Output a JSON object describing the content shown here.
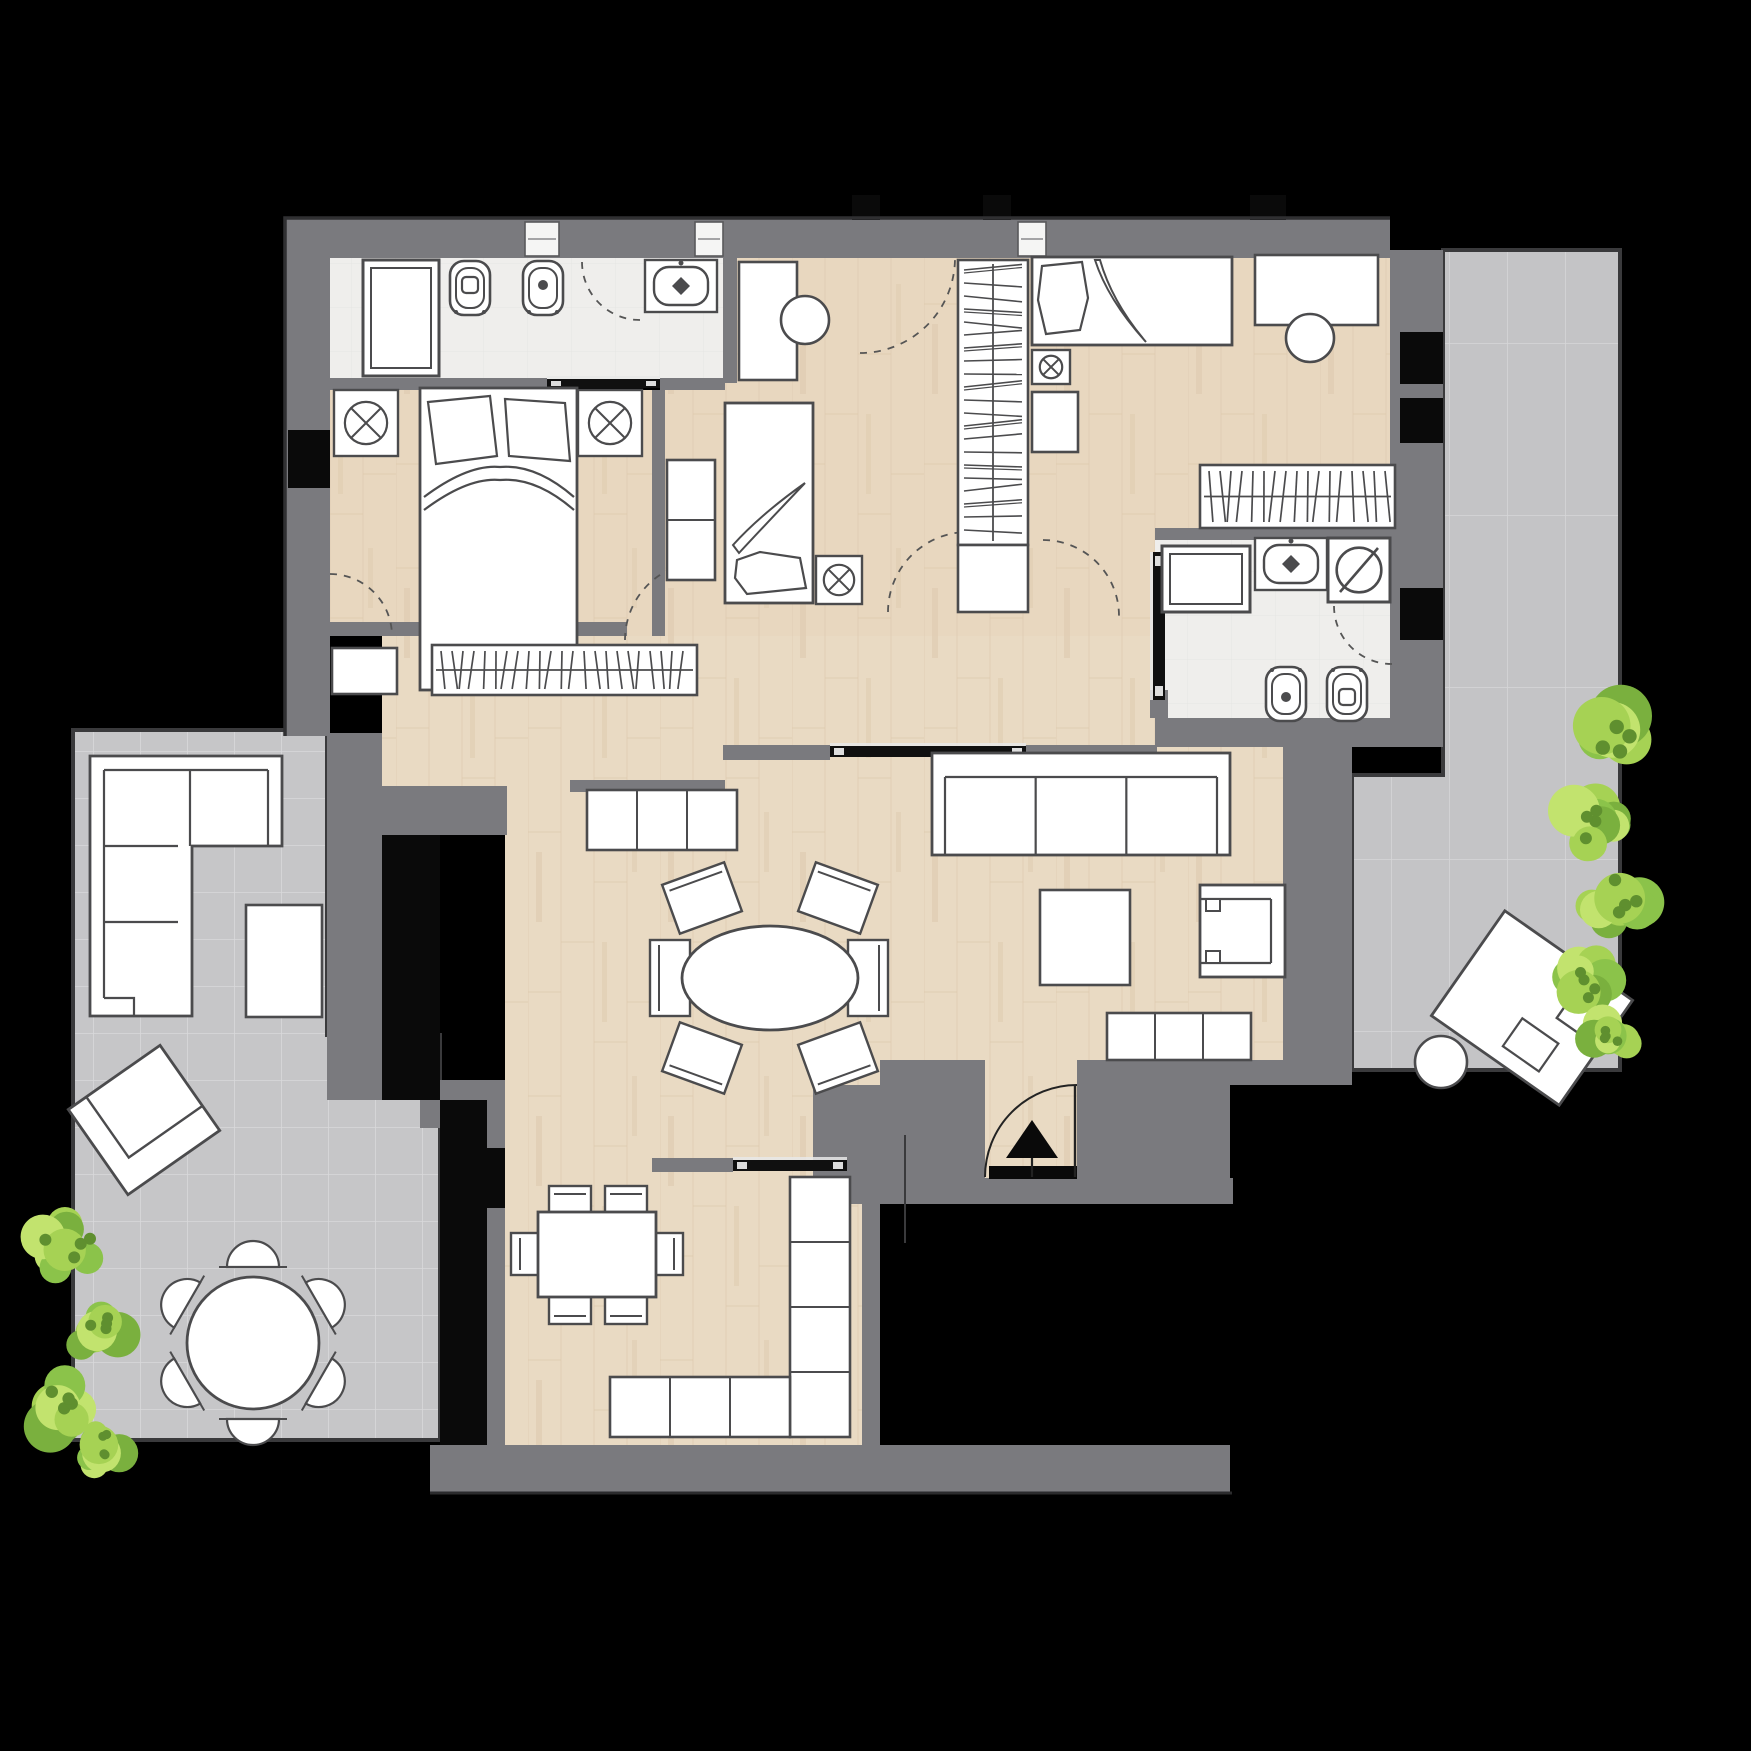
{
  "canvas": {
    "w": 1751,
    "h": 1751
  },
  "palette": {
    "background": "#000000",
    "wall": "#7a7a7e",
    "wallEdge": "#303032",
    "gap": "#0a0a0a",
    "furnFill": "#ffffff",
    "furnStroke": "#4b4b4d",
    "doorBlack": "#101010",
    "arcStroke": "#555555",
    "woodBase": "#e9dac3",
    "woodLine": "#dcc8ab",
    "bedroomTint": "#e3cbb2",
    "tileBase": "#c6c6c8",
    "tileLine": "#d9d9db",
    "bathBase": "#efeeec",
    "bathLine": "#e6e5e3",
    "greens": [
      "#a6d254",
      "#8bc34a",
      "#7ab03e",
      "#c2e36e"
    ],
    "greenDark": "#5f8f2f"
  },
  "elements": [
    {
      "t": "room",
      "name": "terrace-left",
      "floor": "tileA",
      "pts": [
        [
          73,
          730
        ],
        [
          327,
          730
        ],
        [
          327,
          1035
        ],
        [
          440,
          1035
        ],
        [
          440,
          1440
        ],
        [
          73,
          1440
        ]
      ]
    },
    {
      "t": "room",
      "name": "terrace-right",
      "floor": "tileB",
      "pts": [
        [
          1443,
          250
        ],
        [
          1620,
          250
        ],
        [
          1620,
          1070
        ],
        [
          1352,
          1070
        ],
        [
          1352,
          775
        ],
        [
          1443,
          775
        ]
      ]
    },
    {
      "t": "room",
      "name": "bedroom-2-floor",
      "floor": "wood",
      "x": 665,
      "y": 258,
      "w": 365,
      "h": 392,
      "tint": 1
    },
    {
      "t": "room",
      "name": "bedroom-3-floor",
      "floor": "wood",
      "x": 1030,
      "y": 258,
      "w": 360,
      "h": 282,
      "tint": 1
    },
    {
      "t": "room",
      "name": "bedroom-1-floor",
      "floor": "wood",
      "x": 330,
      "y": 390,
      "w": 322,
      "h": 246,
      "tint": 1
    },
    {
      "t": "room",
      "name": "corridor-floor",
      "floor": "wood",
      "x": 652,
      "y": 528,
      "w": 503,
      "h": 132,
      "tint": 1
    },
    {
      "t": "room",
      "name": "hall-floor",
      "floor": "wood",
      "x": 652,
      "y": 636,
      "w": 503,
      "h": 150
    },
    {
      "t": "room",
      "name": "nook-floor",
      "floor": "wood",
      "x": 382,
      "y": 636,
      "w": 341,
      "h": 150
    },
    {
      "t": "room",
      "name": "living-floor",
      "floor": "wood",
      "x": 505,
      "y": 786,
      "w": 778,
      "h": 299
    },
    {
      "t": "room",
      "name": "living-floor-east",
      "floor": "wood",
      "x": 1155,
      "y": 747,
      "w": 128,
      "h": 45
    },
    {
      "t": "room",
      "name": "kitchen-floor",
      "floor": "wood",
      "x": 505,
      "y": 1085,
      "w": 375,
      "h": 360
    },
    {
      "t": "room",
      "name": "bathroom-1-floor",
      "floor": "bath",
      "x": 330,
      "y": 258,
      "w": 393,
      "h": 122
    },
    {
      "t": "room",
      "name": "bathroom-2-floor",
      "floor": "bath",
      "x": 1155,
      "y": 540,
      "w": 235,
      "h": 178
    },
    {
      "t": "walls",
      "name": "wall",
      "rects": [
        [
          285,
          218,
          1105,
          40
        ],
        [
          285,
          258,
          45,
          478
        ],
        [
          1390,
          250,
          53,
          497
        ],
        [
          723,
          258,
          14,
          125
        ],
        [
          330,
          378,
          217,
          12
        ],
        [
          660,
          378,
          65,
          12
        ],
        [
          652,
          390,
          13,
          246
        ],
        [
          330,
          622,
          297,
          14
        ],
        [
          327,
          733,
          55,
          304
        ],
        [
          327,
          786,
          180,
          49
        ],
        [
          327,
          1035,
          113,
          65
        ],
        [
          420,
          1080,
          85,
          48
        ],
        [
          487,
          1085,
          18,
          360
        ],
        [
          570,
          780,
          155,
          12
        ],
        [
          723,
          745,
          107,
          15
        ],
        [
          1025,
          745,
          132,
          15
        ],
        [
          1155,
          528,
          235,
          12
        ],
        [
          1155,
          718,
          235,
          29
        ],
        [
          1150,
          690,
          18,
          28
        ],
        [
          1283,
          745,
          69,
          340
        ],
        [
          880,
          1060,
          472,
          25
        ],
        [
          813,
          1085,
          172,
          95
        ],
        [
          1077,
          1085,
          153,
          95
        ],
        [
          813,
          1178,
          420,
          26
        ],
        [
          862,
          1085,
          18,
          360
        ],
        [
          652,
          1158,
          81,
          14
        ],
        [
          847,
          1158,
          33,
          14
        ],
        [
          430,
          1445,
          800,
          48
        ]
      ]
    },
    {
      "t": "room",
      "name": "entry-bay-floor",
      "floor": "wood",
      "x": 985,
      "y": 1060,
      "w": 92,
      "h": 118
    },
    {
      "t": "blacks",
      "name": "wall-gap",
      "rects": [
        [
          852,
          195,
          28,
          25
        ],
        [
          983,
          195,
          28,
          25
        ],
        [
          1250,
          195,
          36,
          25
        ],
        [
          1400,
          332,
          43,
          52
        ],
        [
          1400,
          398,
          43,
          45
        ],
        [
          1400,
          588,
          43,
          52
        ],
        [
          288,
          430,
          42,
          58
        ],
        [
          382,
          835,
          58,
          265
        ],
        [
          440,
          1100,
          47,
          345
        ],
        [
          487,
          1148,
          18,
          60
        ],
        [
          989,
          1166,
          88,
          13
        ]
      ]
    },
    {
      "t": "windows",
      "name": "window",
      "rects": [
        [
          525,
          222,
          34,
          34
        ],
        [
          695,
          222,
          28,
          34
        ],
        [
          1018,
          222,
          28,
          34
        ]
      ]
    },
    {
      "t": "path",
      "name": "outer-edge",
      "d": "M285,736 L285,218 L1390,218",
      "stroke": "#303032",
      "sw": 3.5
    },
    {
      "t": "path",
      "name": "walk-edge",
      "d": "M430,1493 L1232,1493",
      "stroke": "#2b2b2d",
      "sw": 3
    },
    {
      "t": "slide",
      "name": "sliding-door-bath1",
      "x": 547,
      "y": 379,
      "w": 113,
      "h": 9
    },
    {
      "t": "slide",
      "name": "sliding-door-living",
      "x": 830,
      "y": 746,
      "w": 196,
      "h": 11
    },
    {
      "t": "slide",
      "name": "sliding-door-kitchen",
      "x": 733,
      "y": 1160,
      "w": 114,
      "h": 11
    },
    {
      "t": "slide",
      "name": "pocket-door-bath2",
      "x": 1153,
      "y": 552,
      "w": 12,
      "h": 148
    },
    {
      "t": "arc",
      "name": "door-arc-bedroom1",
      "cx": 703,
      "cy": 640,
      "r": 78,
      "a0": 180,
      "a1": 270
    },
    {
      "t": "arc",
      "name": "door-arc-bedroom1-balcony",
      "cx": 330,
      "cy": 636,
      "r": 62,
      "a0": 270,
      "a1": 0
    },
    {
      "t": "arc",
      "name": "door-arc-bedroom2",
      "cx": 860,
      "cy": 258,
      "r": 95,
      "a0": 90,
      "a1": 0
    },
    {
      "t": "arc",
      "name": "door-arc-corridor",
      "cx": 968,
      "cy": 612,
      "r": 80,
      "a0": 180,
      "a1": 270
    },
    {
      "t": "arc",
      "name": "door-arc-bedroom3",
      "cx": 1043,
      "cy": 616,
      "r": 76,
      "a0": 270,
      "a1": 0
    },
    {
      "t": "arc",
      "name": "door-arc-bath2",
      "cx": 1392,
      "cy": 606,
      "r": 58,
      "a0": 90,
      "a1": 180
    },
    {
      "t": "arc",
      "name": "window-arc-bath1",
      "cx": 640,
      "cy": 262,
      "r": 58,
      "a0": 90,
      "a1": 180
    },
    {
      "t": "shower",
      "name": "shower-tray",
      "x": 363,
      "y": 260,
      "w": 76,
      "h": 116
    },
    {
      "t": "wc",
      "name": "toilet",
      "v": "sq",
      "cx": 470,
      "cy": 288,
      "rot": 0
    },
    {
      "t": "wc",
      "name": "bidet",
      "v": "dot",
      "cx": 543,
      "cy": 288,
      "rot": 0
    },
    {
      "t": "sink",
      "name": "washbasin",
      "cx": 681,
      "cy": 286
    },
    {
      "t": "nightstand",
      "name": "nightstand",
      "x": 334,
      "y": 390,
      "w": 64,
      "h": 66
    },
    {
      "t": "nightstand",
      "name": "nightstand",
      "x": 578,
      "y": 390,
      "w": 64,
      "h": 66
    },
    {
      "t": "bedD",
      "name": "double-bed",
      "x": 420,
      "y": 388,
      "w": 157,
      "h": 302
    },
    {
      "t": "furn",
      "name": "desk",
      "x": 739,
      "y": 262,
      "w": 58,
      "h": 118
    },
    {
      "t": "circle",
      "name": "desk-chair",
      "cx": 805,
      "cy": 320,
      "r": 24
    },
    {
      "t": "segcab",
      "name": "dresser",
      "x": 667,
      "y": 460,
      "w": 48,
      "h": 120,
      "segs": 2,
      "vert": true
    },
    {
      "t": "bedV",
      "name": "single-bed",
      "x": 725,
      "y": 403,
      "w": 88,
      "h": 200
    },
    {
      "t": "nightstand",
      "name": "nightstand",
      "x": 816,
      "y": 556,
      "w": 46,
      "h": 48
    },
    {
      "t": "wardrobe",
      "name": "wardrobe",
      "x": 958,
      "y": 260,
      "w": 70,
      "h": 285
    },
    {
      "t": "furn",
      "name": "wardrobe-cabinet",
      "x": 958,
      "y": 545,
      "w": 70,
      "h": 67
    },
    {
      "t": "bedH",
      "name": "single-bed",
      "x": 1032,
      "y": 257,
      "w": 200,
      "h": 88
    },
    {
      "t": "nightstand",
      "name": "nightstand",
      "x": 1032,
      "y": 350,
      "w": 38,
      "h": 34
    },
    {
      "t": "furn",
      "name": "cabinet",
      "x": 1032,
      "y": 392,
      "w": 46,
      "h": 60
    },
    {
      "t": "furn",
      "name": "desk",
      "x": 1255,
      "y": 255,
      "w": 123,
      "h": 70
    },
    {
      "t": "circle",
      "name": "desk-chair",
      "cx": 1310,
      "cy": 338,
      "r": 24
    },
    {
      "t": "bookshelf",
      "name": "bookshelf",
      "x": 1200,
      "y": 465,
      "w": 195,
      "h": 63
    },
    {
      "t": "bookshelf",
      "name": "bookshelf",
      "x": 432,
      "y": 645,
      "w": 265,
      "h": 50
    },
    {
      "t": "furn",
      "name": "cabinet",
      "x": 332,
      "y": 648,
      "w": 65,
      "h": 46
    },
    {
      "t": "segcab",
      "name": "sideboard",
      "x": 587,
      "y": 790,
      "w": 150,
      "h": 60,
      "segs": 3
    },
    {
      "t": "shower",
      "name": "shower-tray",
      "x": 1162,
      "y": 546,
      "w": 88,
      "h": 66
    },
    {
      "t": "sink",
      "name": "washbasin",
      "cx": 1291,
      "cy": 564
    },
    {
      "t": "washer",
      "name": "washing-machine",
      "x": 1328,
      "y": 538,
      "w": 62,
      "h": 64
    },
    {
      "t": "wc",
      "name": "bidet",
      "v": "dot",
      "cx": 1286,
      "cy": 694,
      "rot": 180
    },
    {
      "t": "wc",
      "name": "toilet",
      "v": "sq",
      "cx": 1347,
      "cy": 694,
      "rot": 180
    },
    {
      "t": "sofa",
      "name": "sofa",
      "x": 932,
      "y": 753,
      "w": 298,
      "h": 102
    },
    {
      "t": "furn",
      "name": "coffee-table",
      "x": 1040,
      "y": 890,
      "w": 90,
      "h": 95
    },
    {
      "t": "armchair",
      "name": "armchair",
      "x": 1200,
      "y": 885,
      "w": 85,
      "h": 92
    },
    {
      "t": "ovalset",
      "name": "dining-table",
      "cx": 770,
      "cy": 978,
      "rx": 88,
      "ry": 52
    },
    {
      "t": "segcab",
      "name": "entry-console",
      "x": 1107,
      "y": 1013,
      "w": 144,
      "h": 47,
      "segs": 3
    },
    {
      "t": "kitset",
      "name": "kitchen-table",
      "x": 538,
      "y": 1212,
      "w": 118,
      "h": 85
    },
    {
      "t": "segcab",
      "name": "kitchen-counter",
      "x": 790,
      "y": 1177,
      "w": 60,
      "h": 260,
      "segs": 4,
      "vert": true
    },
    {
      "t": "segcab",
      "name": "kitchen-counter",
      "x": 610,
      "y": 1377,
      "w": 180,
      "h": 60,
      "segs": 3
    },
    {
      "t": "cornersofa",
      "name": "outdoor-corner-sofa",
      "x": 90,
      "y": 756
    },
    {
      "t": "furn",
      "name": "outdoor-table",
      "x": 246,
      "y": 905,
      "w": 76,
      "h": 112
    },
    {
      "t": "lounge",
      "name": "sun-lounger",
      "cx": 144,
      "cy": 1120,
      "w": 112,
      "h": 104,
      "rot": -35,
      "s": 1
    },
    {
      "t": "roundset",
      "name": "outdoor-dining",
      "cx": 253,
      "cy": 1343,
      "r": 66
    },
    {
      "t": "lounge",
      "name": "sun-lounger",
      "cx": 1532,
      "cy": 1008,
      "w": 156,
      "h": 128,
      "rot": 35,
      "s": 2
    },
    {
      "t": "circle",
      "name": "side-table",
      "cx": 1441,
      "cy": 1062,
      "r": 26
    },
    {
      "t": "entry",
      "name": "entrance-door",
      "tri": [
        [
          1032,
          1120
        ],
        [
          1006,
          1158
        ],
        [
          1058,
          1158
        ]
      ],
      "arc": "M1077,1085 A92,92 0 0 0 985,1177",
      "leaf": [
        1075,
        1085,
        1075,
        1177
      ],
      "stem": [
        1032,
        1158,
        1032,
        1177
      ]
    },
    {
      "t": "line",
      "name": "section-mark",
      "x1": 905,
      "y1": 1135,
      "x2": 905,
      "y2": 1243
    },
    {
      "t": "plant",
      "name": "plant",
      "cx": 1612,
      "cy": 728,
      "s": 60,
      "seed": 1
    },
    {
      "t": "plant",
      "name": "plant",
      "cx": 1596,
      "cy": 820,
      "s": 50,
      "seed": 2
    },
    {
      "t": "plant",
      "name": "plant",
      "cx": 1618,
      "cy": 900,
      "s": 52,
      "seed": 3
    },
    {
      "t": "plant",
      "name": "plant",
      "cx": 1580,
      "cy": 978,
      "s": 46,
      "seed": 4
    },
    {
      "t": "plant",
      "name": "plant",
      "cx": 1608,
      "cy": 1038,
      "s": 40,
      "seed": 5
    },
    {
      "t": "plant",
      "name": "plant",
      "cx": 66,
      "cy": 1245,
      "s": 50,
      "seed": 6
    },
    {
      "t": "plant",
      "name": "plant",
      "cx": 98,
      "cy": 1330,
      "s": 46,
      "seed": 7
    },
    {
      "t": "plant",
      "name": "plant",
      "cx": 60,
      "cy": 1408,
      "s": 52,
      "seed": 8
    },
    {
      "t": "plant",
      "name": "plant",
      "cx": 100,
      "cy": 1452,
      "s": 38,
      "seed": 9
    }
  ]
}
